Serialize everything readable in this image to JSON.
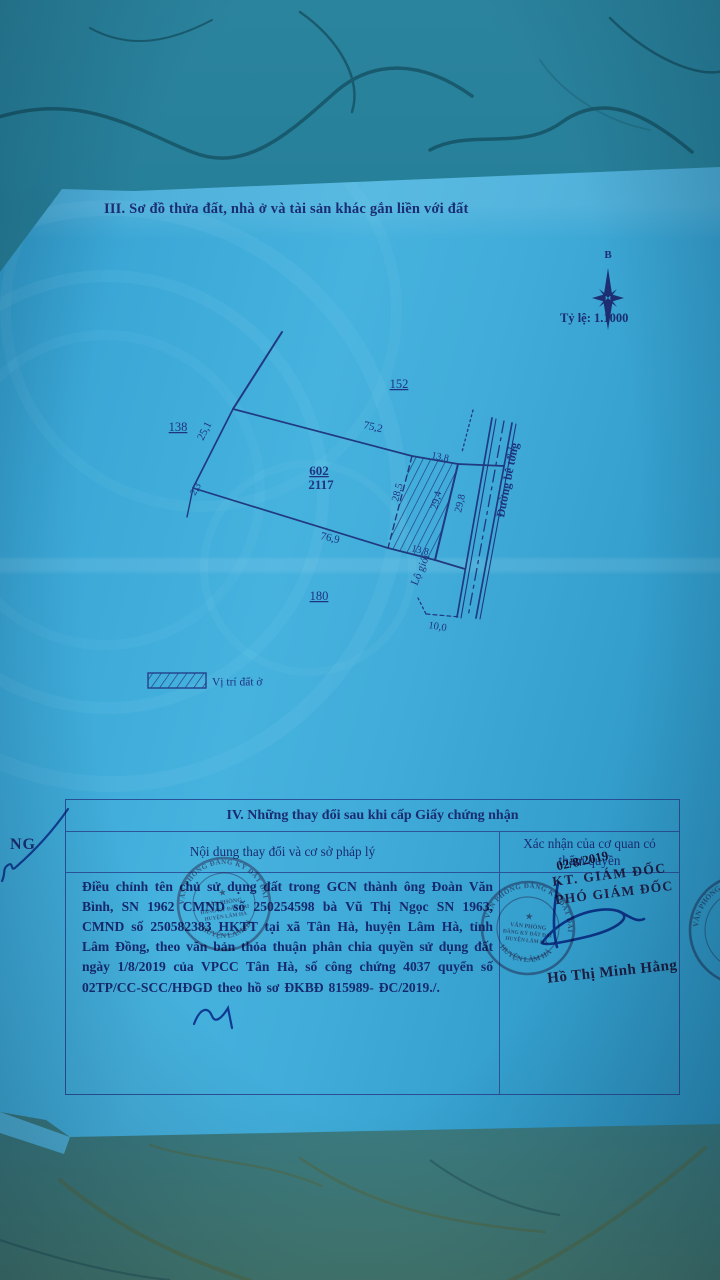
{
  "section3": {
    "title": "III. Sơ đồ thửa đất, nhà ở và tài sản khác gắn liền với đất",
    "compass_north": "B",
    "scale": "Tỷ lệ: 1.1000",
    "legend_label": "Vị trí đất ở",
    "plot": {
      "parcel_number": "602",
      "parcel_area": "2117",
      "neighbor_top": "152",
      "neighbor_left": "138",
      "neighbor_bottom": "180",
      "dim_top": "75,2",
      "dim_left": "25,1",
      "dim_left_ext": "2,3",
      "dim_bottom": "76,9",
      "dim_hatch_top": "13,8",
      "dim_hatch_left": "28,5",
      "dim_hatch_right": "29,4",
      "dim_hatch_bottom": "13,8",
      "dim_frontage": "29,8",
      "dim_road_top": "4,1",
      "dim_road_width": "10,0",
      "setback_label": "Lộ giới",
      "road_name": "Đường bê tông"
    }
  },
  "section4": {
    "title": "IV. Những thay đổi sau khi cấp Giấy chứng nhận",
    "col_left_header": "Nội dung thay đổi và cơ sở pháp lý",
    "col_right_header": "Xác nhận của cơ quan có thẩm quyền",
    "entry_text": "Điều chỉnh tên chủ sử dụng đất trong GCN thành ông Đoàn Văn Bình, SN 1962 CMND số 250254598 bà Vũ Thị Ngọc SN 1963, CMND số 250582383  HKTT tại xã Tân Hà, huyện Lâm Hà, tỉnh Lâm Đồng, theo văn bản thỏa thuận phân chia quyền sử dụng đất ngày 1/8/2019 của VPCC Tân Hà, số công chứng 4037 quyển số 02TP/CC-SCC/HĐGD theo hồ sơ ĐKBĐ 815989- ĐC/2019./.",
    "stamp_date": "02/8/2019",
    "sign_title_1": "KT. GIÁM ĐỐC",
    "sign_title_2": "PHÓ GIÁM ĐỐC",
    "signer_name": "Hồ Thị Minh Hằng",
    "seal_ring_top": "VĂN PHÒNG ĐĂNG KÝ ĐẤT ĐAI",
    "seal_ring_bottom": "HUYỆN LÂM HÀ",
    "seal_center_1": "VĂN PHÒNG",
    "seal_center_2": "ĐĂNG KÝ ĐẤT ĐAI",
    "seal_center_3": "HUYỆN LÂM HÀ"
  },
  "stray_text": "NG",
  "colors": {
    "paper_blue": "#3ba7d6",
    "ink_navy": "#1b2d72",
    "stamp_red": "#8d2f52",
    "pen_blue": "#24419e",
    "marble_teal": "#2b849e"
  }
}
